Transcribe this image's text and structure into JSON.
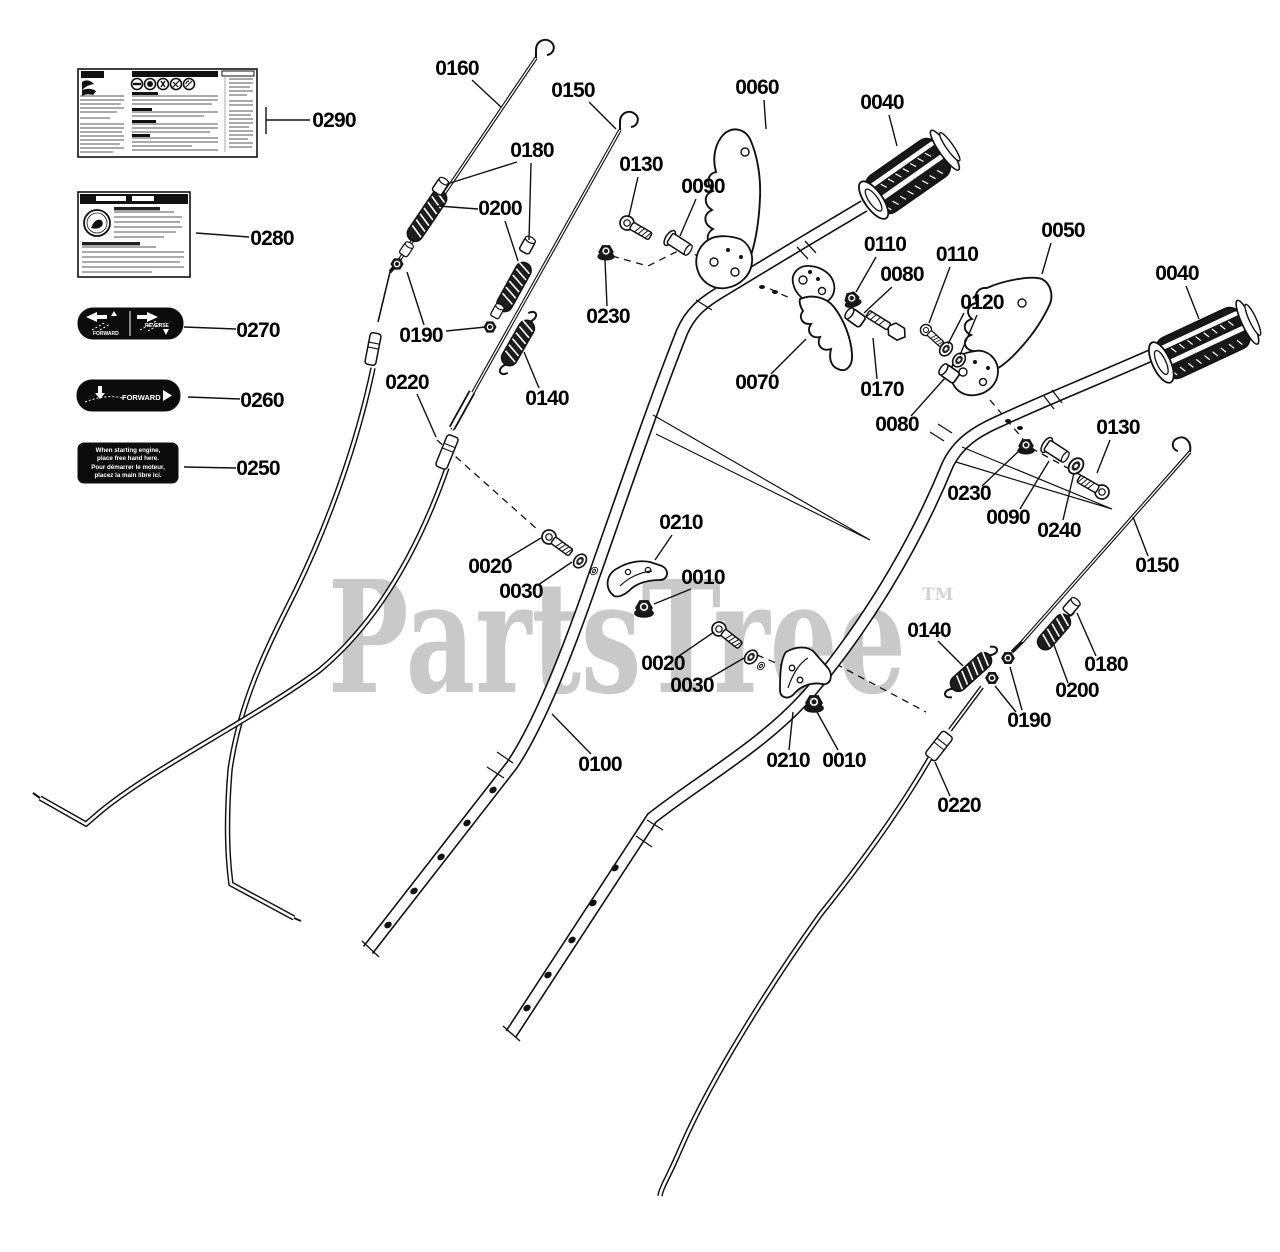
{
  "watermark": {
    "text": "PartsTree",
    "tm": "TM",
    "color": "#c9c9c9"
  },
  "diagram": {
    "line_color": "#111111",
    "background": "#ffffff"
  },
  "decals": {
    "direction": {
      "forward": "FORWARD",
      "reverse": "REVERSE"
    },
    "forward": {
      "text": "FORWARD"
    },
    "hand": {
      "line1": "When starting engine,",
      "line2": "place free hand here.",
      "line3": "Pour démarrer le moteur,",
      "line4": "placez la main libre ici."
    }
  },
  "callouts": [
    {
      "label": "0290",
      "x": 334,
      "y": 121,
      "lines": [
        [
          310,
          120,
          266,
          120
        ],
        [
          266,
          107,
          266,
          134
        ]
      ]
    },
    {
      "label": "0280",
      "x": 272,
      "y": 239,
      "lines": [
        [
          249,
          237,
          196,
          233
        ]
      ]
    },
    {
      "label": "0270",
      "x": 258,
      "y": 331,
      "lines": [
        [
          236,
          329,
          184,
          327
        ]
      ]
    },
    {
      "label": "0260",
      "x": 262,
      "y": 401,
      "lines": [
        [
          240,
          399,
          188,
          397
        ]
      ]
    },
    {
      "label": "0250",
      "x": 258,
      "y": 469,
      "lines": [
        [
          236,
          468,
          184,
          467
        ]
      ]
    },
    {
      "label": "0160",
      "x": 457,
      "y": 69,
      "lines": [
        [
          472,
          80,
          501,
          107
        ]
      ]
    },
    {
      "label": "0150",
      "x": 573,
      "y": 91,
      "lines": [
        [
          589,
          102,
          616,
          129
        ]
      ]
    },
    {
      "label": "0180",
      "x": 532,
      "y": 151,
      "lines": [
        [
          517,
          162,
          447,
          184
        ],
        [
          531,
          163,
          529,
          240
        ]
      ]
    },
    {
      "label": "0200",
      "x": 500,
      "y": 209,
      "lines": [
        [
          478,
          209,
          438,
          206
        ],
        [
          505,
          221,
          518,
          261
        ]
      ]
    },
    {
      "label": "0190",
      "x": 421,
      "y": 336,
      "lines": [
        [
          424,
          325,
          407,
          272
        ],
        [
          446,
          331,
          486,
          327
        ]
      ]
    },
    {
      "label": "0220",
      "x": 407,
      "y": 383,
      "lines": [
        [
          417,
          394,
          436,
          437
        ]
      ]
    },
    {
      "label": "0140",
      "x": 547,
      "y": 399,
      "lines": [
        [
          539,
          388,
          524,
          352
        ]
      ]
    },
    {
      "label": "0230",
      "x": 608,
      "y": 317,
      "lines": [
        [
          607,
          306,
          605,
          260
        ]
      ]
    },
    {
      "label": "0130",
      "x": 641,
      "y": 165,
      "lines": [
        [
          638,
          177,
          629,
          216
        ]
      ]
    },
    {
      "label": "0090",
      "x": 703,
      "y": 187,
      "lines": [
        [
          696,
          199,
          680,
          236
        ]
      ]
    },
    {
      "label": "0060",
      "x": 757,
      "y": 88,
      "lines": [
        [
          764,
          100,
          766,
          129
        ]
      ]
    },
    {
      "label": "0040",
      "x": 882,
      "y": 103,
      "lines": [
        [
          889,
          115,
          897,
          146
        ]
      ]
    },
    {
      "label": "0110",
      "x": 885,
      "y": 245,
      "lines": [
        [
          876,
          257,
          856,
          292
        ]
      ]
    },
    {
      "label": "0080",
      "x": 902,
      "y": 275,
      "lines": [
        [
          892,
          287,
          864,
          313
        ]
      ]
    },
    {
      "label": "0070",
      "x": 757,
      "y": 383,
      "lines": [
        [
          771,
          374,
          806,
          339
        ]
      ]
    },
    {
      "label": "0170",
      "x": 882,
      "y": 390,
      "lines": [
        [
          877,
          379,
          873,
          338
        ]
      ]
    },
    {
      "label": "0110",
      "x": 957,
      "y": 255,
      "lines": [
        [
          950,
          267,
          929,
          323
        ]
      ]
    },
    {
      "label": "0120",
      "x": 982,
      "y": 303,
      "lines": [
        [
          964,
          313,
          948,
          344
        ],
        [
          977,
          315,
          960,
          355
        ]
      ]
    },
    {
      "label": "0080",
      "x": 897,
      "y": 425,
      "lines": [
        [
          911,
          416,
          945,
          378
        ]
      ]
    },
    {
      "label": "0050",
      "x": 1063,
      "y": 231,
      "lines": [
        [
          1051,
          243,
          1042,
          274
        ]
      ]
    },
    {
      "label": "0040",
      "x": 1177,
      "y": 274,
      "lines": [
        [
          1186,
          286,
          1199,
          319
        ]
      ]
    },
    {
      "label": "0230",
      "x": 969,
      "y": 494,
      "lines": [
        [
          982,
          486,
          1021,
          449
        ]
      ]
    },
    {
      "label": "0090",
      "x": 1008,
      "y": 518,
      "lines": [
        [
          1020,
          509,
          1049,
          461
        ]
      ]
    },
    {
      "label": "0240",
      "x": 1059,
      "y": 531,
      "lines": [
        [
          1063,
          520,
          1074,
          473
        ]
      ]
    },
    {
      "label": "0130",
      "x": 1118,
      "y": 428,
      "lines": [
        [
          1110,
          440,
          1097,
          473
        ]
      ]
    },
    {
      "label": "0150",
      "x": 1157,
      "y": 566,
      "lines": [
        [
          1148,
          556,
          1133,
          517
        ]
      ]
    },
    {
      "label": "0140",
      "x": 929,
      "y": 631,
      "lines": [
        [
          938,
          641,
          963,
          666
        ]
      ]
    },
    {
      "label": "0180",
      "x": 1106,
      "y": 665,
      "lines": [
        [
          1096,
          656,
          1077,
          613
        ]
      ]
    },
    {
      "label": "0200",
      "x": 1077,
      "y": 691,
      "lines": [
        [
          1068,
          683,
          1054,
          645
        ]
      ]
    },
    {
      "label": "0190",
      "x": 1029,
      "y": 721,
      "lines": [
        [
          1022,
          710,
          1010,
          667
        ],
        [
          1016,
          712,
          995,
          686
        ]
      ]
    },
    {
      "label": "0210",
      "x": 681,
      "y": 523,
      "lines": [
        [
          672,
          535,
          655,
          560
        ]
      ]
    },
    {
      "label": "0010",
      "x": 703,
      "y": 578,
      "lines": [
        [
          691,
          589,
          654,
          604
        ]
      ]
    },
    {
      "label": "0020",
      "x": 490,
      "y": 567,
      "lines": [
        [
          506,
          559,
          541,
          538
        ]
      ]
    },
    {
      "label": "0030",
      "x": 521,
      "y": 592,
      "lines": [
        [
          538,
          585,
          572,
          562
        ]
      ]
    },
    {
      "label": "0020",
      "x": 663,
      "y": 664,
      "lines": [
        [
          679,
          656,
          714,
          632
        ]
      ]
    },
    {
      "label": "0030",
      "x": 692,
      "y": 686,
      "lines": [
        [
          708,
          679,
          744,
          658
        ]
      ]
    },
    {
      "label": "0210",
      "x": 788,
      "y": 761,
      "lines": [
        [
          789,
          750,
          793,
          712
        ]
      ]
    },
    {
      "label": "0010",
      "x": 844,
      "y": 761,
      "lines": [
        [
          838,
          750,
          817,
          712
        ]
      ]
    },
    {
      "label": "0100",
      "x": 600,
      "y": 765,
      "lines": [
        [
          591,
          754,
          552,
          714
        ]
      ]
    },
    {
      "label": "0220",
      "x": 959,
      "y": 806,
      "lines": [
        [
          950,
          796,
          935,
          762
        ]
      ]
    }
  ]
}
